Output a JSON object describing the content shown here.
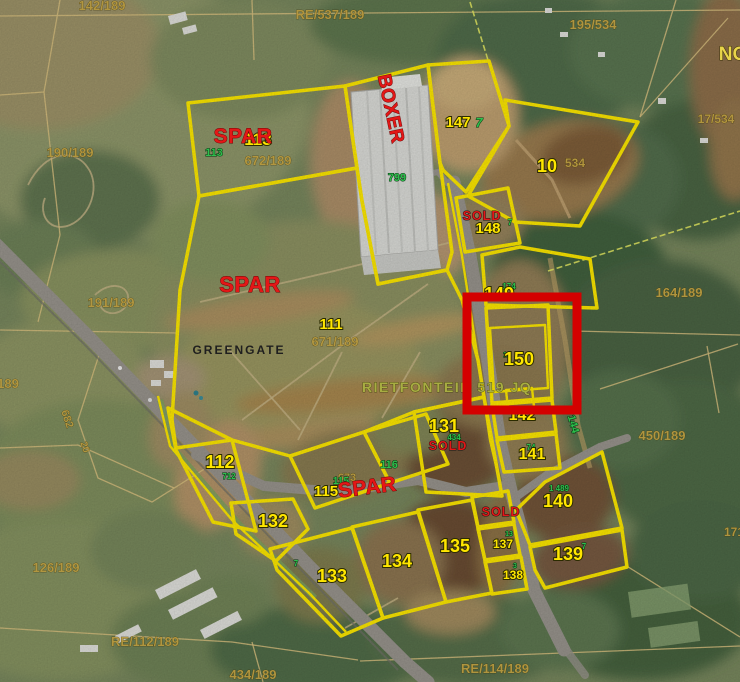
{
  "title": "Rietfontein 519 JQ development stands aerial map",
  "highlight": {
    "lot": "150",
    "color": "#d40000"
  },
  "colors": {
    "parcel_yellow": "#f9e400",
    "highlight_red": "#d40000",
    "lot_text_yellow": "#ffe600",
    "green_text": "#2fbf4d",
    "cadastral_text": "#b5983f",
    "brand_red": "#e31717"
  },
  "labels": {
    "lot_numbers": [
      {
        "text": "113",
        "x": 258,
        "y": 145,
        "size": 17
      },
      {
        "text": "147",
        "x": 458,
        "y": 127,
        "size": 15
      },
      {
        "text": "10",
        "x": 547,
        "y": 172,
        "size": 18
      },
      {
        "text": "148",
        "x": 488,
        "y": 233,
        "size": 15
      },
      {
        "text": "149",
        "x": 499,
        "y": 300,
        "size": 18
      },
      {
        "text": "150",
        "x": 519,
        "y": 365,
        "size": 18
      },
      {
        "text": "142",
        "x": 522,
        "y": 420,
        "size": 16
      },
      {
        "text": "141",
        "x": 532,
        "y": 459,
        "size": 16
      },
      {
        "text": "140",
        "x": 558,
        "y": 507,
        "size": 18
      },
      {
        "text": "139",
        "x": 568,
        "y": 560,
        "size": 18
      },
      {
        "text": "138",
        "x": 513,
        "y": 579,
        "size": 12
      },
      {
        "text": "137",
        "x": 503,
        "y": 548,
        "size": 12
      },
      {
        "text": "135",
        "x": 455,
        "y": 552,
        "size": 18
      },
      {
        "text": "134",
        "x": 397,
        "y": 567,
        "size": 18
      },
      {
        "text": "133",
        "x": 332,
        "y": 582,
        "size": 18
      },
      {
        "text": "132",
        "x": 273,
        "y": 527,
        "size": 18
      },
      {
        "text": "131",
        "x": 444,
        "y": 432,
        "size": 18
      },
      {
        "text": "115",
        "x": 326,
        "y": 496,
        "size": 15
      },
      {
        "text": "112",
        "x": 220,
        "y": 468,
        "size": 18
      },
      {
        "text": "111",
        "x": 331,
        "y": 329,
        "size": 15
      }
    ],
    "brands": [
      {
        "text": "SPAR",
        "x": 243,
        "y": 143,
        "size": 21
      },
      {
        "text": "SPAR",
        "x": 250,
        "y": 292,
        "size": 22
      },
      {
        "text": "SPAR",
        "x": 368,
        "y": 494,
        "size": 21,
        "rot": -7
      },
      {
        "text": "BOXER",
        "x": 385,
        "y": 110,
        "size": 19,
        "rot": 78
      }
    ],
    "sold_text": "SOLD",
    "sold_positions": [
      {
        "x": 482,
        "y": 220,
        "size": 12.5
      },
      {
        "x": 448,
        "y": 450,
        "size": 12.5
      },
      {
        "x": 501,
        "y": 516,
        "size": 12.5
      }
    ],
    "green": [
      {
        "text": "113",
        "x": 214,
        "y": 156,
        "size": 11
      },
      {
        "text": "799",
        "x": 397,
        "y": 181,
        "size": 11
      },
      {
        "text": "7",
        "x": 479,
        "y": 127,
        "size": 13,
        "italic": true
      },
      {
        "text": "116",
        "x": 389,
        "y": 468,
        "size": 11
      },
      {
        "text": "115",
        "x": 341,
        "y": 484,
        "size": 10
      },
      {
        "text": "144",
        "x": 570,
        "y": 425,
        "size": 11,
        "rot": 75
      },
      {
        "text": "434",
        "x": 454,
        "y": 440,
        "size": 8
      },
      {
        "text": "712",
        "x": 229,
        "y": 479,
        "size": 8
      },
      {
        "text": "174",
        "x": 509,
        "y": 289,
        "size": 8
      },
      {
        "text": "14",
        "x": 507,
        "y": 357,
        "size": 7
      },
      {
        "text": "74",
        "x": 531,
        "y": 450,
        "size": 8
      },
      {
        "text": "1 489",
        "x": 559,
        "y": 491,
        "size": 8
      },
      {
        "text": "7",
        "x": 584,
        "y": 549,
        "size": 8
      },
      {
        "text": "13",
        "x": 509,
        "y": 536,
        "size": 7
      },
      {
        "text": "3",
        "x": 515,
        "y": 568,
        "size": 7
      },
      {
        "text": "7",
        "x": 296,
        "y": 566,
        "size": 8
      },
      {
        "text": "7",
        "x": 510,
        "y": 225,
        "size": 8
      }
    ],
    "cadastral": [
      {
        "text": "142/189",
        "x": 102,
        "y": 10,
        "size": 13
      },
      {
        "text": "RE/537/189",
        "x": 330,
        "y": 19,
        "size": 13
      },
      {
        "text": "195/534",
        "x": 593,
        "y": 29,
        "size": 13
      },
      {
        "text": "190/189",
        "x": 70,
        "y": 157,
        "size": 13
      },
      {
        "text": "672/189",
        "x": 268,
        "y": 165,
        "size": 13
      },
      {
        "text": "191/189",
        "x": 111,
        "y": 307,
        "size": 13
      },
      {
        "text": "671/189",
        "x": 335,
        "y": 346,
        "size": 13
      },
      {
        "text": "164/189",
        "x": 679,
        "y": 297,
        "size": 13
      },
      {
        "text": "450/189",
        "x": 662,
        "y": 440,
        "size": 13
      },
      {
        "text": "126/189",
        "x": 56,
        "y": 572,
        "size": 13
      },
      {
        "text": "RE/112/189",
        "x": 145,
        "y": 646,
        "size": 13
      },
      {
        "text": "434/189",
        "x": 253,
        "y": 679,
        "size": 13
      },
      {
        "text": "RE/114/189",
        "x": 495,
        "y": 673,
        "size": 13
      },
      {
        "text": "534",
        "x": 575,
        "y": 167,
        "size": 12
      },
      {
        "text": "673",
        "x": 347,
        "y": 481,
        "size": 11
      },
      {
        "text": "17/534",
        "x": 716,
        "y": 123,
        "size": 12
      },
      {
        "text": "171",
        "x": 734,
        "y": 536,
        "size": 12
      },
      {
        "text": "189",
        "x": 8,
        "y": 388,
        "size": 13
      },
      {
        "text": "682",
        "x": 64,
        "y": 420,
        "size": 11,
        "rot": 72
      },
      {
        "text": "20",
        "x": 82,
        "y": 448,
        "size": 10,
        "rot": 72
      }
    ],
    "place": {
      "text": "GREENGATE",
      "x": 239,
      "y": 354,
      "size": 12
    },
    "locality": {
      "text": "RIETFONTEIN 519 JQ",
      "x": 362,
      "y": 392,
      "size": 14
    },
    "edge": [
      {
        "text": "NO",
        "x": 733,
        "y": 60,
        "size": 19
      }
    ]
  }
}
